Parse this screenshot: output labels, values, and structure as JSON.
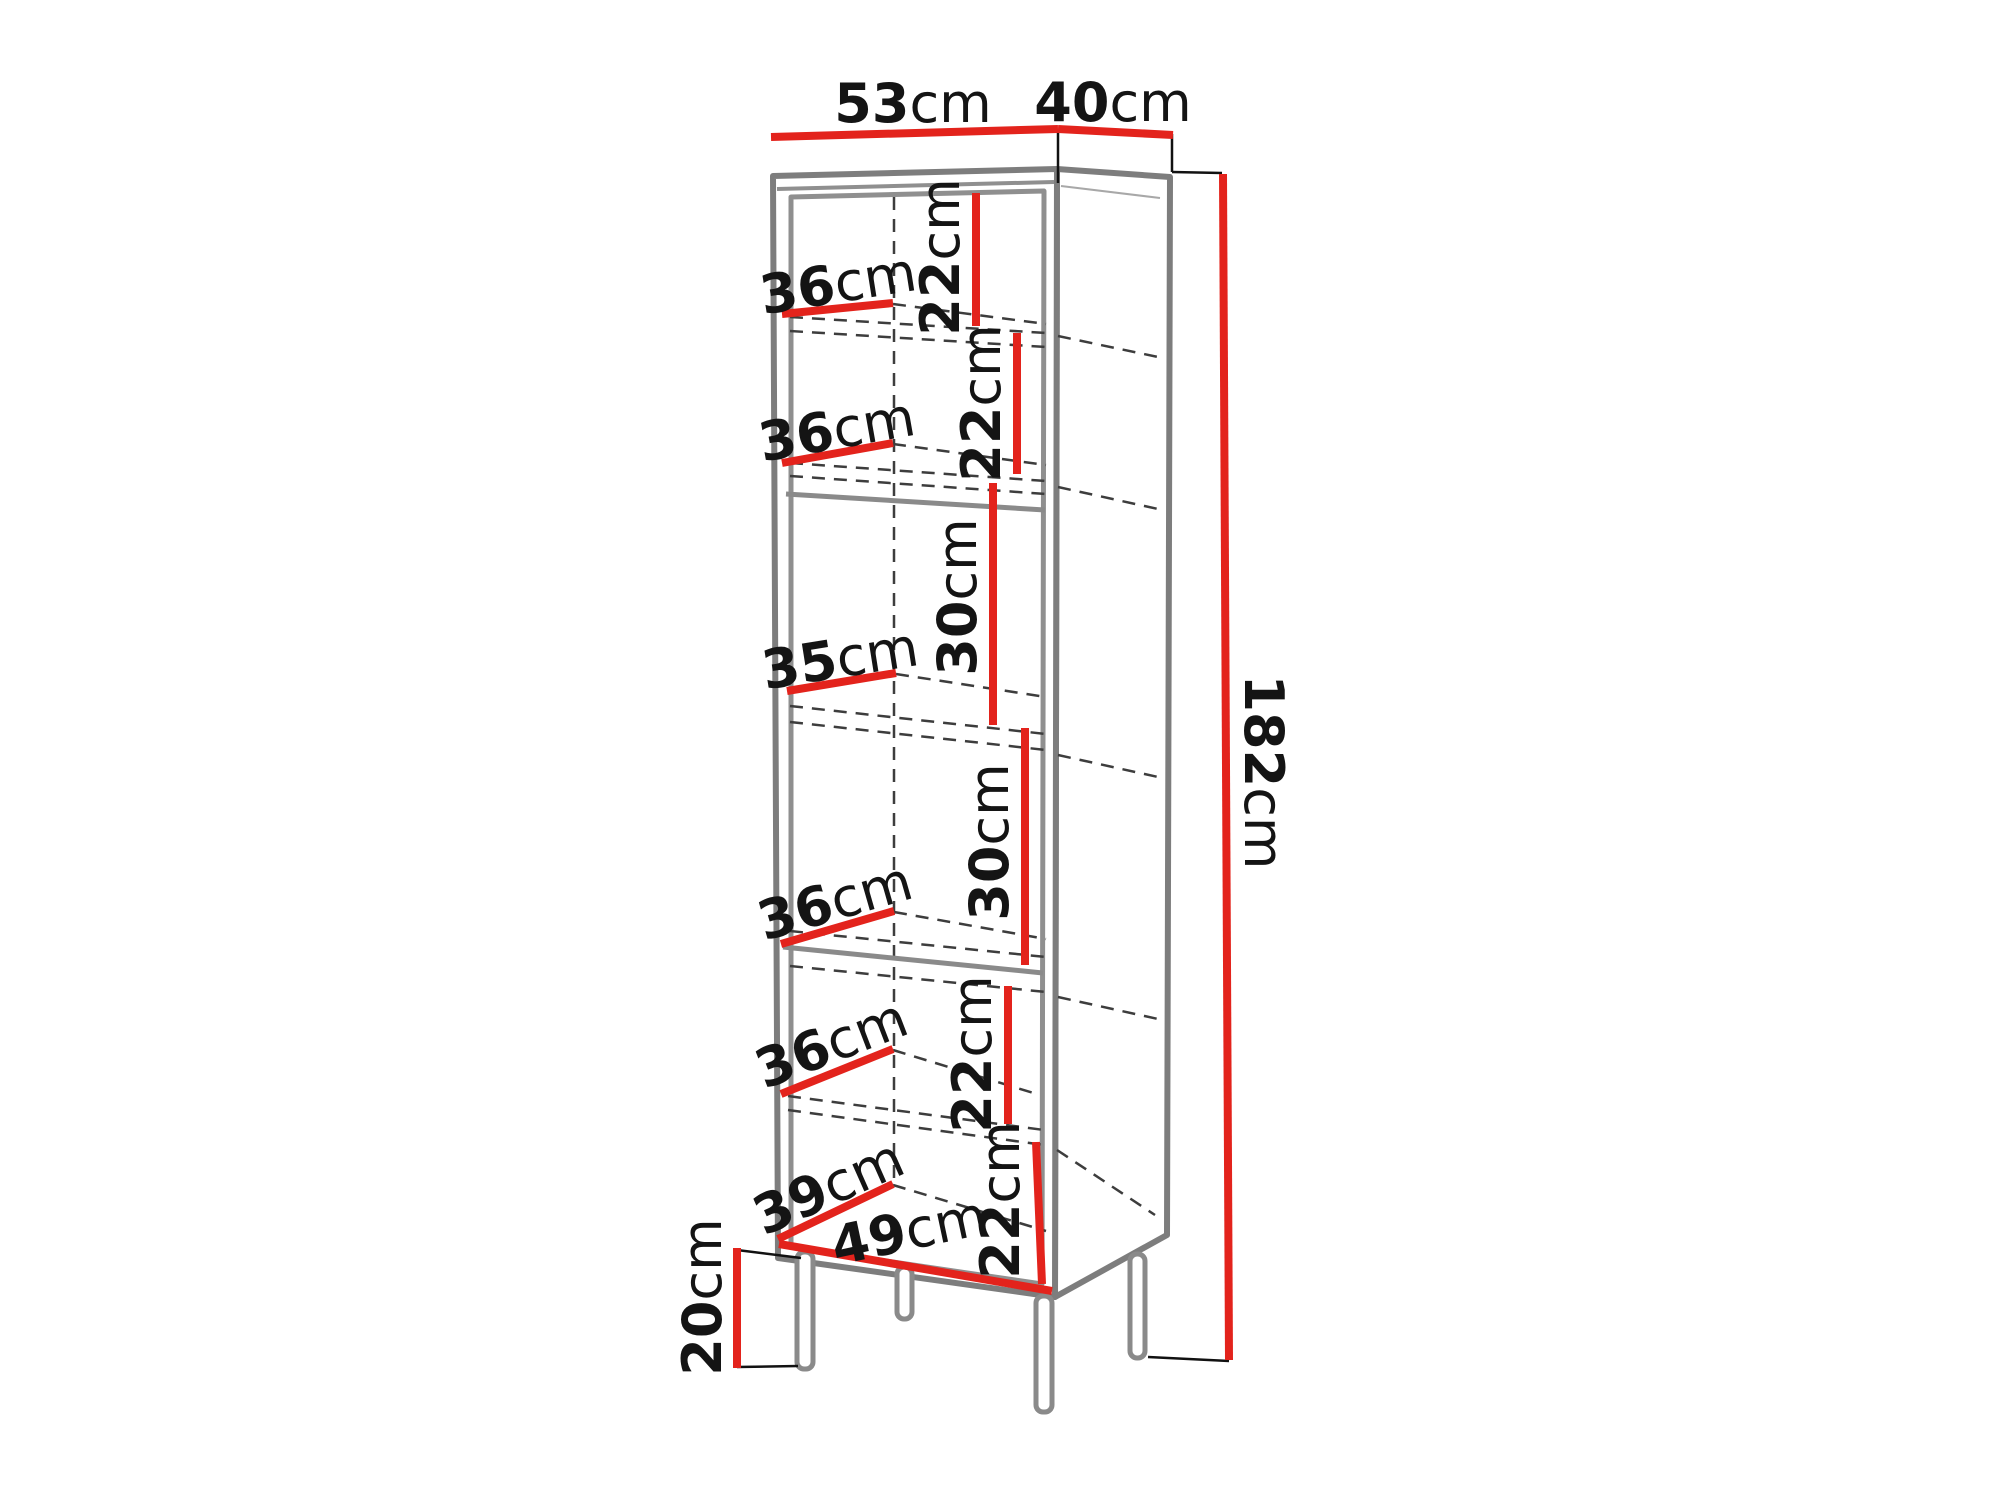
{
  "diagram": {
    "kind": "furniture-dimension-diagram",
    "unit": "cm",
    "colors": {
      "dimension_line": "#e3231c",
      "cabinet_outline": "#7d7d7d",
      "hidden_edge": "#3d3d3d",
      "label_text": "#141414",
      "background": "#ffffff"
    },
    "overall": {
      "top_width": {
        "value": "53",
        "unit": "cm"
      },
      "top_depth": {
        "value": "40",
        "unit": "cm"
      },
      "total_height": {
        "value": "182",
        "unit": "cm"
      },
      "leg_height": {
        "value": "20",
        "unit": "cm"
      }
    },
    "compartments": [
      {
        "depth": {
          "value": "36",
          "unit": "cm"
        },
        "height": {
          "value": "22",
          "unit": "cm"
        }
      },
      {
        "depth": {
          "value": "36",
          "unit": "cm"
        },
        "height": {
          "value": "22",
          "unit": "cm"
        }
      },
      {
        "depth": {
          "value": "35",
          "unit": "cm"
        },
        "height": {
          "value": "30",
          "unit": "cm"
        }
      },
      {
        "depth": {
          "value": "36",
          "unit": "cm"
        },
        "height": {
          "value": "30",
          "unit": "cm"
        }
      },
      {
        "depth": {
          "value": "36",
          "unit": "cm"
        },
        "height": {
          "value": "22",
          "unit": "cm"
        }
      },
      {
        "depth": {
          "value": "39",
          "unit": "cm"
        },
        "width": {
          "value": "49",
          "unit": "cm"
        },
        "height": {
          "value": "22",
          "unit": "cm"
        }
      }
    ]
  }
}
